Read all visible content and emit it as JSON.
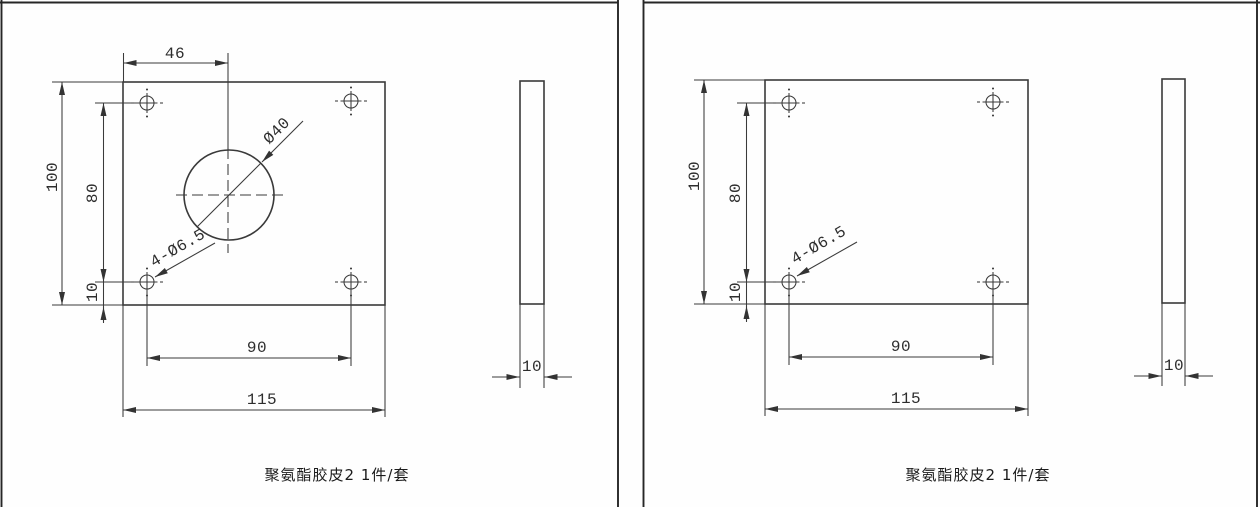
{
  "drawing": {
    "panels": [
      {
        "caption": "聚氨酯胶皮2 1件/套",
        "dims": {
          "width_top": "46",
          "plate_height": "100",
          "hole_row_span": "80",
          "edge_offset": "10",
          "hole_col_span": "90",
          "plate_width": "115",
          "thickness": "10",
          "center_hole": "Ø40",
          "corner_holes": "4-Ø6.5"
        }
      },
      {
        "caption": "聚氨酯胶皮2 1件/套",
        "dims": {
          "plate_height": "100",
          "hole_row_span": "80",
          "edge_offset": "10",
          "hole_col_span": "90",
          "plate_width": "115",
          "thickness": "10",
          "corner_holes": "4-Ø6.5"
        }
      }
    ],
    "colors": {
      "line": "#3a3a3a",
      "border": "#262626",
      "background": "#fefefe"
    }
  }
}
